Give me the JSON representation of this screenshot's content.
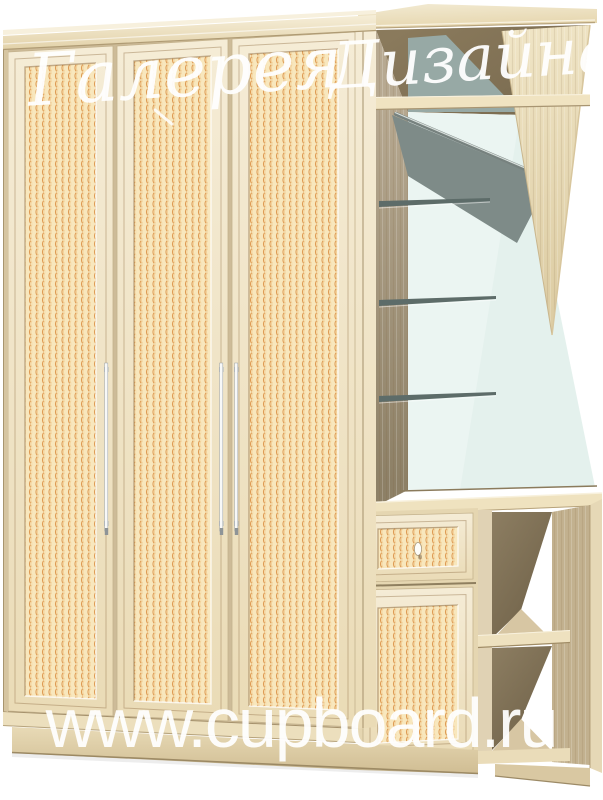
{
  "watermarks": {
    "script_full": "Галерея Дизайна",
    "script_word1": "Галерея",
    "script_word2": "Дизайна",
    "site_url": "www.cupboard.ru"
  },
  "palette": {
    "background": "#ffffff",
    "wood_light": "#f3e9d1",
    "wood_frame": "#e8dab8",
    "wood_side": "#cdbb98",
    "rattan_base": "#f8e7bd",
    "rattan_weave": "#de9c55",
    "interior_wall": "#a3957c",
    "interior_shadow": "#6f6148",
    "mirror": "#e4f1ed",
    "mirror_upper": "#97a9a5",
    "mirror_shadow_band": "#7e8b88",
    "glass_shelf": "#5d6c69",
    "handle_metal": "#f7f8f8",
    "watermark": "#ffffff"
  },
  "scene": {
    "door_count": 3,
    "door_handle_count": 3,
    "glass_shelf_count": 3,
    "drawer_count": 1,
    "open_shelf_compartments": 2
  }
}
